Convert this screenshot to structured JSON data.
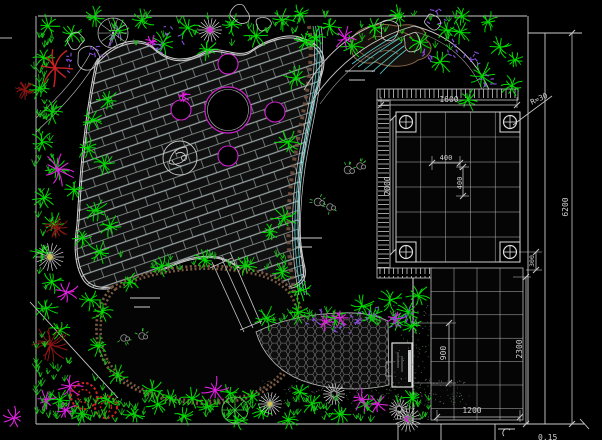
{
  "drawing": {
    "background": "#000000",
    "dims": {
      "d1600": "1600",
      "r30": "R=30",
      "c400a": "400",
      "c400b": "400",
      "d2000": "2000",
      "d300": "300",
      "d2300": "2300",
      "d900": "900",
      "d1200": "1200",
      "d6200": "6200",
      "note": "0.15"
    },
    "colors": {
      "plant_green": "#00dd00",
      "grass_green": "#18c018",
      "magenta": "#dd22dd",
      "purple": "#8a4fe0",
      "red": "#cc2222",
      "dark_red": "#8a1515",
      "line_white": "#cccccc",
      "rock_brown": "#8a6648",
      "water_cyan": "#55cccc",
      "dim_text": "#d0d0d0"
    },
    "planting": {
      "palms": [
        [
          48,
          26,
          12
        ],
        [
          72,
          34,
          13
        ],
        [
          95,
          17,
          11
        ],
        [
          118,
          30,
          13
        ],
        [
          142,
          20,
          12
        ],
        [
          163,
          44,
          13
        ],
        [
          188,
          28,
          12
        ],
        [
          207,
          50,
          11
        ],
        [
          232,
          24,
          12
        ],
        [
          256,
          36,
          12
        ],
        [
          282,
          20,
          12
        ],
        [
          305,
          42,
          12
        ],
        [
          330,
          26,
          12
        ],
        [
          352,
          46,
          12
        ],
        [
          300,
          14,
          10
        ],
        [
          375,
          28,
          11
        ],
        [
          398,
          16,
          11
        ],
        [
          420,
          42,
          12
        ],
        [
          447,
          30,
          12
        ],
        [
          462,
          16,
          11
        ],
        [
          440,
          62,
          14
        ],
        [
          460,
          32,
          12
        ],
        [
          482,
          76,
          14
        ],
        [
          500,
          47,
          12
        ],
        [
          512,
          86,
          12
        ],
        [
          468,
          100,
          11
        ],
        [
          488,
          22,
          11
        ],
        [
          515,
          60,
          10
        ],
        [
          44,
          58,
          11
        ],
        [
          40,
          88,
          12
        ],
        [
          52,
          112,
          12
        ],
        [
          42,
          142,
          12
        ],
        [
          56,
          168,
          13
        ],
        [
          44,
          198,
          12
        ],
        [
          54,
          224,
          12
        ],
        [
          42,
          252,
          12
        ],
        [
          52,
          282,
          12
        ],
        [
          46,
          308,
          12
        ],
        [
          88,
          148,
          12
        ],
        [
          104,
          164,
          12
        ],
        [
          74,
          190,
          11
        ],
        [
          96,
          210,
          12
        ],
        [
          110,
          226,
          12
        ],
        [
          82,
          238,
          11
        ],
        [
          100,
          252,
          12
        ],
        [
          92,
          120,
          11
        ],
        [
          108,
          100,
          11
        ],
        [
          296,
          78,
          13
        ],
        [
          288,
          142,
          13
        ],
        [
          284,
          218,
          13
        ],
        [
          300,
          290,
          12
        ],
        [
          316,
          38,
          11
        ],
        [
          270,
          232,
          9
        ],
        [
          162,
          266,
          11
        ],
        [
          205,
          260,
          11
        ],
        [
          246,
          266,
          11
        ],
        [
          282,
          272,
          10
        ],
        [
          152,
          390,
          12
        ],
        [
          192,
          398,
          11
        ],
        [
          230,
          393,
          10
        ],
        [
          130,
          282,
          10
        ],
        [
          102,
          312,
          11
        ],
        [
          98,
          346,
          11
        ],
        [
          118,
          375,
          11
        ],
        [
          170,
          398,
          11
        ],
        [
          90,
          300,
          11
        ],
        [
          60,
          330,
          11
        ],
        [
          266,
          318,
          12
        ],
        [
          298,
          312,
          12
        ],
        [
          334,
          318,
          12
        ],
        [
          362,
          306,
          12
        ],
        [
          390,
          300,
          13
        ],
        [
          408,
          312,
          12
        ],
        [
          418,
          296,
          12
        ],
        [
          372,
          316,
          11
        ],
        [
          398,
          322,
          11
        ],
        [
          412,
          326,
          10
        ],
        [
          60,
          400,
          12
        ],
        [
          82,
          414,
          11
        ],
        [
          108,
          400,
          12
        ],
        [
          134,
          414,
          11
        ],
        [
          158,
          404,
          12
        ],
        [
          184,
          416,
          11
        ],
        [
          208,
          406,
          11
        ],
        [
          238,
          420,
          10
        ],
        [
          262,
          412,
          11
        ],
        [
          288,
          420,
          10
        ],
        [
          312,
          404,
          11
        ],
        [
          340,
          414,
          11
        ],
        [
          366,
          404,
          11
        ],
        [
          412,
          398,
          10
        ],
        [
          300,
          392,
          10
        ],
        [
          252,
          396,
          10
        ]
      ],
      "magenta_stars": [
        [
          58,
          170,
          16
        ],
        [
          66,
          292,
          13
        ],
        [
          70,
          386,
          13
        ],
        [
          46,
          400,
          11
        ],
        [
          66,
          410,
          11
        ],
        [
          14,
          418,
          11
        ],
        [
          215,
          390,
          13
        ],
        [
          362,
          400,
          12
        ],
        [
          378,
          404,
          11
        ],
        [
          340,
          318,
          10
        ],
        [
          345,
          38,
          12
        ],
        [
          183,
          96,
          7
        ],
        [
          152,
          42,
          7
        ],
        [
          325,
          322,
          9
        ],
        [
          395,
          318,
          9
        ]
      ],
      "purple_clumps": [
        [
          70,
          64,
          10
        ],
        [
          174,
          34,
          10
        ],
        [
          115,
          36,
          8
        ],
        [
          438,
          16,
          10
        ],
        [
          450,
          50,
          10
        ],
        [
          472,
          58,
          9
        ],
        [
          490,
          84,
          10
        ],
        [
          428,
          58,
          8
        ],
        [
          315,
          318,
          9
        ],
        [
          342,
          326,
          9
        ],
        [
          368,
          314,
          9
        ],
        [
          392,
          322,
          9
        ],
        [
          410,
          314,
          8
        ],
        [
          358,
          322,
          8
        ],
        [
          160,
          46,
          8
        ],
        [
          96,
          50,
          8
        ]
      ],
      "red_stars": [
        [
          55,
          68,
          20
        ]
      ],
      "dark_ferns": [
        [
          57,
          228,
          12
        ],
        [
          50,
          345,
          19
        ],
        [
          25,
          90,
          10
        ]
      ],
      "red_rings": [
        [
          84,
          396,
          13
        ],
        [
          106,
          407,
          11
        ]
      ],
      "daisies": [
        [
          210,
          30,
          12,
          "magenta"
        ],
        [
          50,
          257,
          14,
          "yellow"
        ],
        [
          270,
          404,
          12,
          "yellow"
        ],
        [
          408,
          419,
          13,
          "magenta"
        ],
        [
          334,
          394,
          11,
          "none"
        ],
        [
          399,
          409,
          10,
          "none"
        ]
      ],
      "green_wheels": [
        [
          235,
          410,
          13
        ]
      ],
      "trees": [
        [
          113,
          33,
          15
        ]
      ],
      "shrubs": [
        [
          240,
          15,
          9
        ],
        [
          263,
          24,
          8
        ],
        [
          390,
          30,
          10
        ],
        [
          412,
          42,
          9
        ],
        [
          432,
          22,
          8
        ],
        [
          88,
          58,
          11
        ],
        [
          75,
          40,
          9
        ]
      ],
      "rocks": [
        [
          348,
          170,
          7
        ],
        [
          360,
          166,
          6
        ],
        [
          318,
          202,
          7
        ],
        [
          330,
          207,
          6
        ],
        [
          124,
          338,
          6
        ],
        [
          142,
          336,
          6
        ]
      ],
      "water_marks": [
        [
          130,
          298
        ],
        [
          292,
          238
        ],
        [
          345,
          71
        ]
      ],
      "grass_regions": [
        [
          34,
          30,
          20,
          370,
          45
        ],
        [
          40,
          396,
          390,
          26,
          75
        ],
        [
          120,
          256,
          170,
          16,
          18
        ],
        [
          42,
          14,
          420,
          36,
          40
        ],
        [
          255,
          312,
          180,
          16,
          16
        ],
        [
          36,
          360,
          70,
          60,
          25
        ]
      ],
      "dot_regions": [
        [
          258,
          380,
          212,
          24,
          240
        ],
        [
          392,
          302,
          38,
          118,
          140
        ]
      ]
    }
  }
}
